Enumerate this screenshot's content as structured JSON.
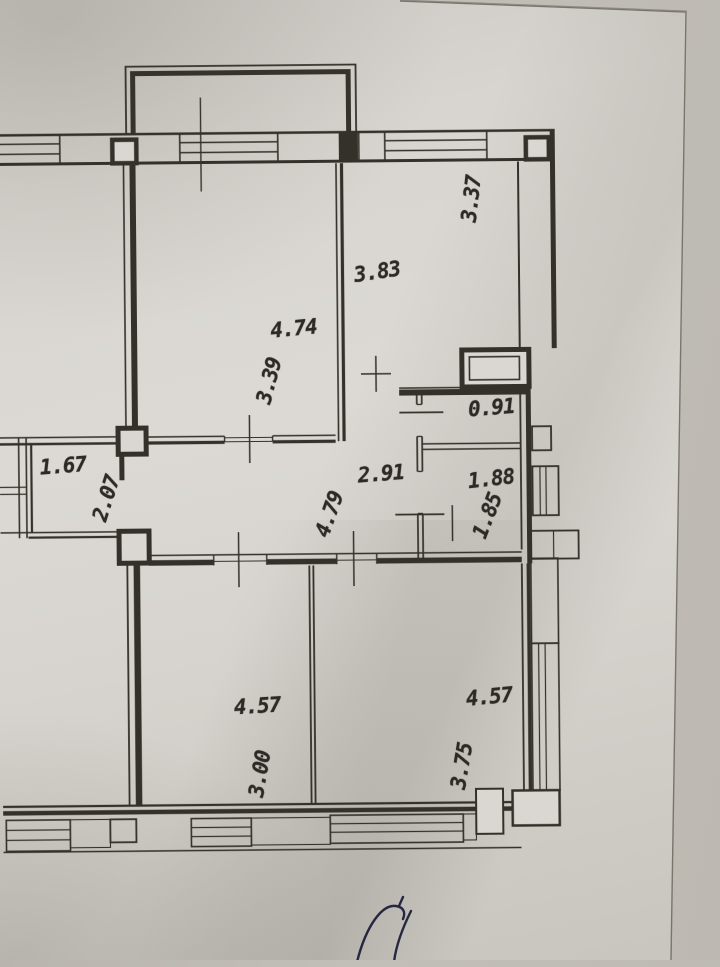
{
  "floor_plan": {
    "dimension_labels": [
      {
        "id": "top-right-room-width",
        "text": "3.83",
        "orientation": "horizontal"
      },
      {
        "id": "top-right-room-depth",
        "text": "3.37",
        "orientation": "vertical"
      },
      {
        "id": "top-left-room-length",
        "text": "4.74",
        "orientation": "horizontal"
      },
      {
        "id": "top-left-room-width",
        "text": "3.39",
        "orientation": "vertical"
      },
      {
        "id": "wc-width",
        "text": "0.91",
        "orientation": "horizontal"
      },
      {
        "id": "hallway-width",
        "text": "2.91",
        "orientation": "horizontal"
      },
      {
        "id": "bathroom-width",
        "text": "1.88",
        "orientation": "horizontal"
      },
      {
        "id": "bathroom-depth",
        "text": "1.85",
        "orientation": "vertical"
      },
      {
        "id": "left-balcony-width",
        "text": "1.67",
        "orientation": "horizontal"
      },
      {
        "id": "left-balcony-depth",
        "text": "2.07",
        "orientation": "vertical"
      },
      {
        "id": "hallway-length",
        "text": "4.79",
        "orientation": "vertical"
      },
      {
        "id": "bottom-left-room-length",
        "text": "4.57",
        "orientation": "horizontal"
      },
      {
        "id": "bottom-left-room-width",
        "text": "3.00",
        "orientation": "vertical"
      },
      {
        "id": "bottom-right-room-length",
        "text": "4.57",
        "orientation": "horizontal"
      },
      {
        "id": "bottom-right-room-width",
        "text": "3.75",
        "orientation": "vertical"
      }
    ],
    "colors": {
      "paper": "#d9d6d1",
      "surface_background": "#beb9b3",
      "drawing_line": "#34312b",
      "signature_ink": "#272741"
    }
  }
}
